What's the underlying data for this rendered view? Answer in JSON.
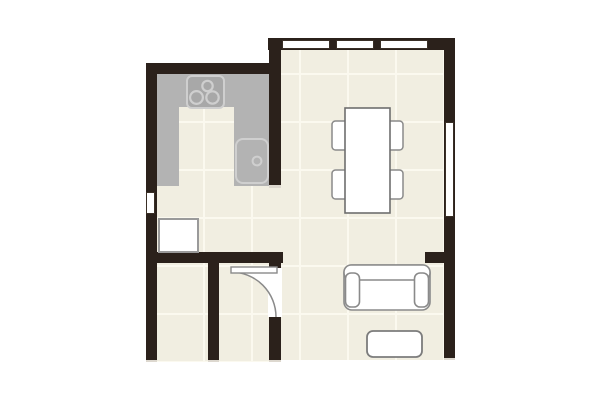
{
  "meta": {
    "type": "architectural-floor-plan",
    "visible_text": "none"
  },
  "palette": {
    "wall": "#2b211b",
    "wall_cut_cap": "#ddd8cf",
    "floor": "#f1eee1",
    "floor_grid_line": "#fbf9ef",
    "kitchen_counter": "#b3b3b3",
    "appliance_fill": "#a8a8a8",
    "appliance_outline": "#cfcfcf",
    "furniture_outline": "#8a8a8a",
    "window_fill": "#ffffff",
    "page_background": "#ffffff"
  },
  "rooms": [
    {
      "name": "kitchen",
      "floor": "tiled",
      "features": [
        "u-shaped-counter",
        "cooktop",
        "sink",
        "cabinet"
      ]
    },
    {
      "name": "living-dining-room",
      "floor": "tiled",
      "features": [
        "dining-table",
        "four-chairs",
        "sofa",
        "coffee-table"
      ]
    },
    {
      "name": "hall-left",
      "floor": "tiled",
      "features": []
    },
    {
      "name": "hall-center",
      "floor": "tiled",
      "features": [
        "swing-door"
      ]
    }
  ],
  "fixtures": {
    "windows": [
      {
        "location": "top-wall",
        "panes": 3
      },
      {
        "location": "right-wall",
        "panes": 1
      },
      {
        "location": "left-wall",
        "panes": 1
      }
    ],
    "door": {
      "location": "hall-center-right-wall",
      "style": "quarter-circle-swing",
      "hinge": "top"
    }
  },
  "kitchen": {
    "counter_shape": "U-shape open to bottom",
    "appliances": [
      {
        "name": "cooktop",
        "burners": 3
      },
      {
        "name": "sink",
        "drain_circles": 1
      }
    ],
    "cabinet_count": 1
  },
  "furniture": [
    {
      "name": "dining-table",
      "chairs": 4,
      "orientation": "vertical"
    },
    {
      "name": "sofa",
      "arms": 2,
      "facing": "down"
    },
    {
      "name": "coffee-table",
      "shape": "rounded-rectangle"
    }
  ]
}
